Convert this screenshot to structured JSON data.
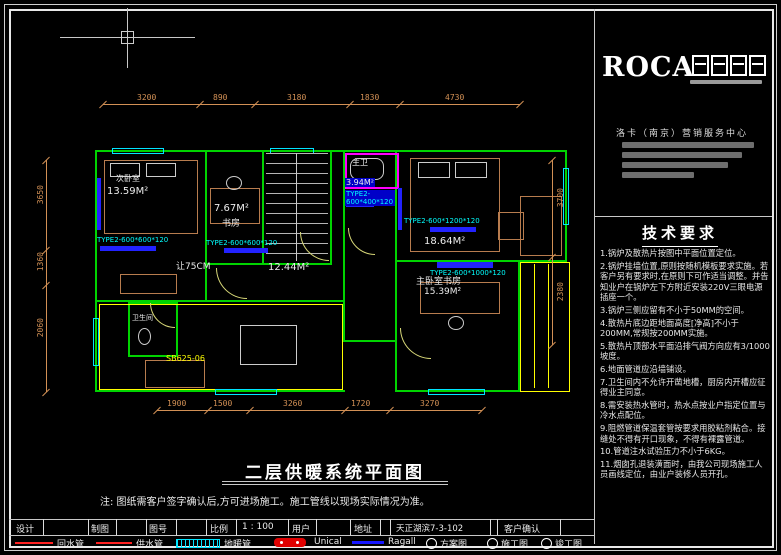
{
  "company": {
    "brand": "ROCA",
    "center": "洛卡（南京）营销服务中心"
  },
  "tech": {
    "title": "技术要求",
    "items": [
      "1.锅炉及散热片按图中平面位置定位。",
      "2.锅炉挂墙位置,原则按随机模板要求实施。若客户另有要求时,在原则下可作适当调整。并告知业户在锅炉左下方附近安装220V三眼电源插座一个。",
      "3.锅炉三侧应留有不小于50MM的空间。",
      "4.散热片底边距地面高度[净高]不小于200MM,常规按200MM实施。",
      "5.散热片顶部水平面沿排气阀方向应有3/1000坡度。",
      "6.地面管道应沿墙铺设。",
      "7.卫生间内不允许开凿地槽，厨房内开槽应征得业主同意。",
      "8.需安装热水管时，热水点按业户指定位置与冷水点配位。",
      "9.阻燃管道保温套管按要求用胶粘剂粘合。接缝处不得有开口现象，不得有裸露管道。",
      "10.管道注水试验压力不小于6KG。",
      "11.烟囱孔退装潢面时，由我公司现场施工人员画线定位，由业户装修人员开孔。"
    ]
  },
  "drawing": {
    "title": "二层供暖系统平面图",
    "note": "注: 图纸需客户签字确认后,方可进场施工。施工管线以现场实际情况为准。"
  },
  "plan": {
    "rooms": {
      "bedroom2_name": "次卧室",
      "bedroom2_area": "13.59M²",
      "study_area": "7.67M²",
      "study_name": "书房",
      "master_bath_name": "主卫",
      "master_bath_area": "3.94M²",
      "master_bedroom_area": "18.64M²",
      "master_study_name": "主卧室书房",
      "master_study_area": "15.39M²",
      "hall_area": "12.44M²",
      "wc_name": "卫生间"
    },
    "annotations": {
      "clearance": "让75CM",
      "boiler_model": "SB625-06",
      "rad1": "TYPE2-600*600*120",
      "rad2": "TYPE2-600*600*120",
      "rad3": "TYPE2-600*1200*120",
      "rad4": "TYPE2-600*1000*120",
      "rad5": "TYPE2-600*400*120"
    }
  },
  "dims": {
    "top": [
      "3200",
      "890",
      "3180",
      "1830",
      "4730"
    ],
    "bottom": [
      "1900",
      "1500",
      "3260",
      "1720",
      "3270"
    ],
    "left": [
      "3650",
      "1360",
      "2060"
    ],
    "right": [
      "3700",
      "2380"
    ]
  },
  "title_block": {
    "f1": "设计",
    "f2": "制图",
    "f3": "图号",
    "f4": "比例",
    "scale_value": "1 : 100",
    "f5": "用户",
    "f6": "地址",
    "project": "天正湖滨7-3-102",
    "confirm": "客户确认"
  },
  "legend": {
    "return_pipe": "回水管",
    "supply_pipe": "供水管",
    "floor_heating_pipe": "地暖管",
    "boiler_brand": "Unical",
    "radiator_brand": "Ragall",
    "scheme": "方案图",
    "construction": "施工图",
    "completion": "竣工图"
  },
  "colors": {
    "wall": "#00d400",
    "window": "#00e5ff",
    "radiator": "#2222ff",
    "dimension": "#d29055",
    "accent_yellow": "#ffff00",
    "bath": "#ff00ff",
    "pipe_red": "#ff2020",
    "pipe_blue": "#1515ff"
  }
}
